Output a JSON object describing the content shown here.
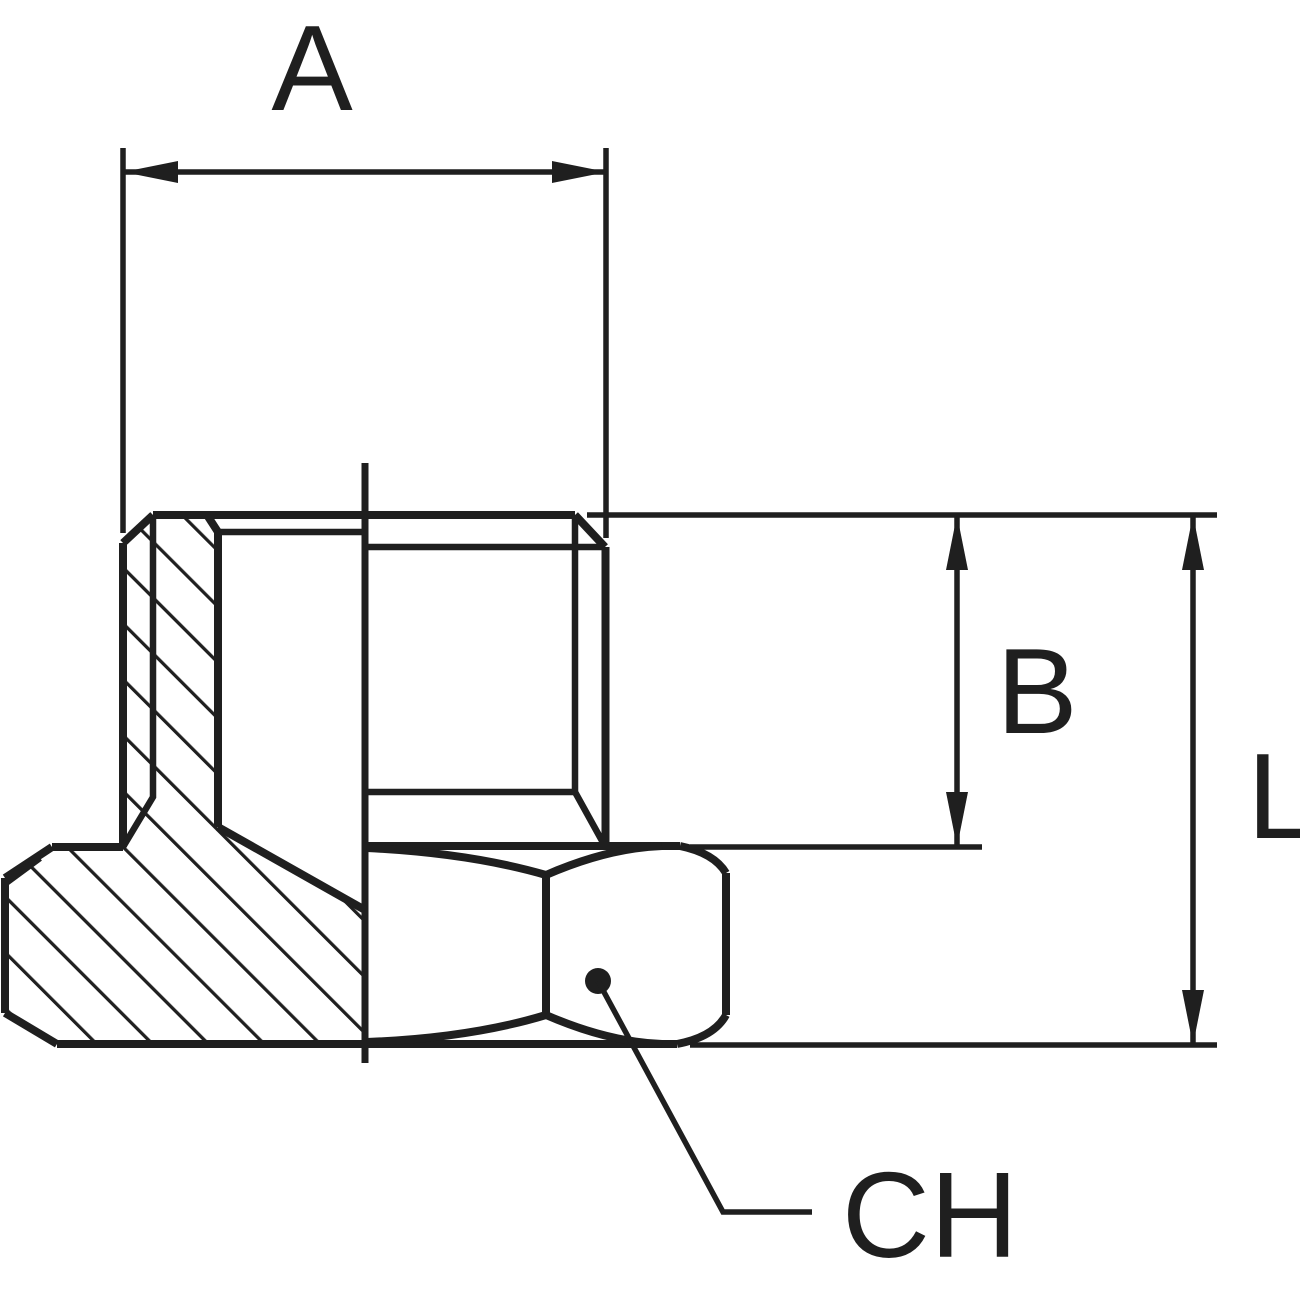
{
  "drawing": {
    "kind": "technical-drawing",
    "view": "half-section of threaded hex plug fitting",
    "colors": {
      "line": "#1f1f1f",
      "background": "#ffffff"
    },
    "dimensions": {
      "a": {
        "label": "A"
      },
      "b": {
        "label": "B"
      },
      "l": {
        "label": "L"
      },
      "ch": {
        "label": "CH"
      }
    }
  }
}
